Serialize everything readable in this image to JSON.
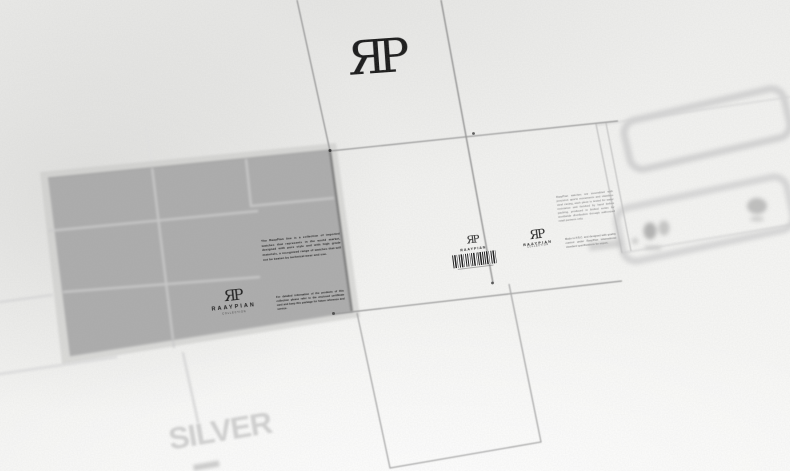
{
  "watermark": {
    "text": "SILVER"
  },
  "top_panel": {
    "monogram": "ЯP"
  },
  "gray_panel": {
    "paragraph_main": "The RaayPian line is a collection of imported watches that represents in the world market, designed with pure style and with high grade materials, a recognized range of watches that will not be beaten by technical wear and use.",
    "paragraph_secondary": "For detailed information of the products of this collection please refer to the enclosed certificate card and keep this package for future reference and service.",
    "logo": {
      "monogram": "ЯP",
      "wordmark": "RAAYPIAN",
      "tagline": "COLLECTION"
    }
  },
  "front_panel": {
    "logo": {
      "monogram": "ЯP",
      "wordmark": "RAAYPIAN"
    },
    "barcode_icon": "barcode"
  },
  "side_panel": {
    "logo": {
      "monogram": "ЯP",
      "wordmark": "RAAYPIAN",
      "tagline": "COLLECTION"
    }
  },
  "right_panel": {
    "paragraph_top": "RaayPian watches are assembled with precision quartz movements and stainless steel casing, each piece is tested for water resistance and finished by hand before packing, produced in limited series for worldwide distribution through authorized retail partners only.",
    "paragraph_bottom": "Made in P.R.C. and designed with quality control under RaayPian international standard specifications for export."
  },
  "colors": {
    "paper": "#f4f4f2",
    "panel_gray": "#aaaaaa",
    "dieline": "#969696",
    "ink": "#131313",
    "ghost": "#d3d3d3",
    "watermark": "#b2b2b2"
  }
}
